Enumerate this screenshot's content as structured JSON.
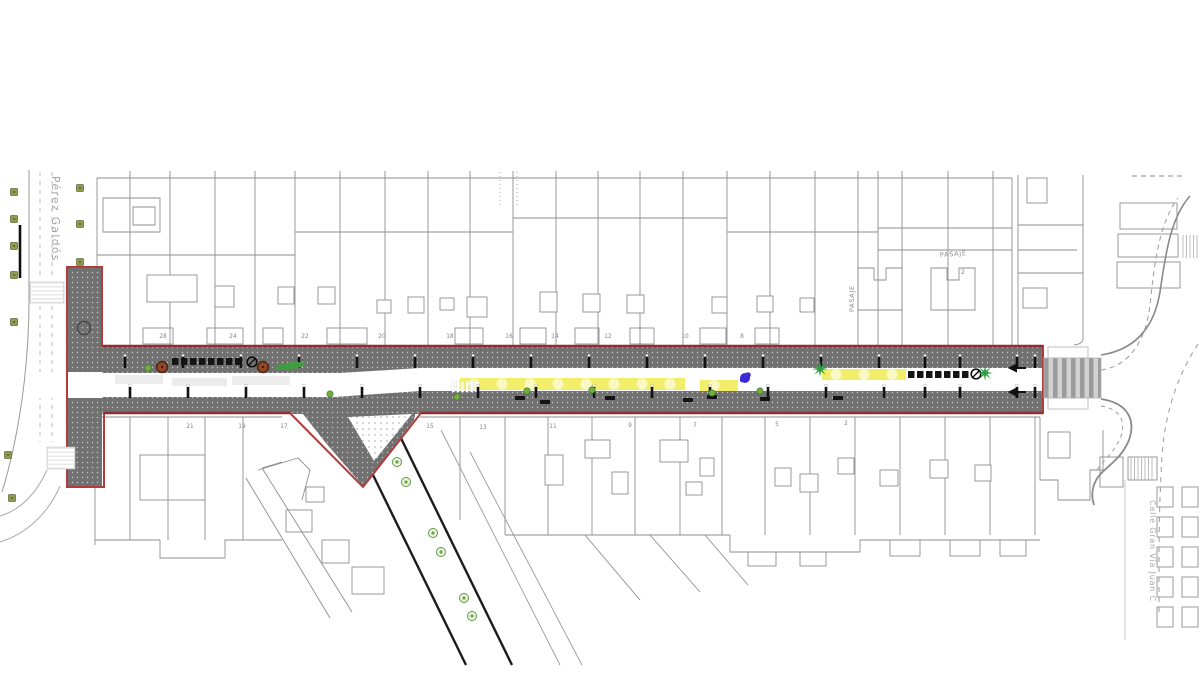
{
  "page": {
    "background": "#ffffff",
    "type": "urban-street-redevelopment-plan"
  },
  "labels": {
    "street_left": "Pérez Galdós",
    "street_right": "Calle Gran Vía Juan C",
    "passage_vertical": "PASAJE",
    "passage_horizontal": "PASAJE"
  },
  "building_numbers": {
    "north": [
      {
        "n": "28",
        "x": 163,
        "y": 338
      },
      {
        "n": "24",
        "x": 233,
        "y": 338
      },
      {
        "n": "22",
        "x": 305,
        "y": 338
      },
      {
        "n": "20",
        "x": 382,
        "y": 338
      },
      {
        "n": "18",
        "x": 450,
        "y": 338
      },
      {
        "n": "16",
        "x": 509,
        "y": 338
      },
      {
        "n": "14",
        "x": 555,
        "y": 338
      },
      {
        "n": "12",
        "x": 608,
        "y": 338
      },
      {
        "n": "10",
        "x": 685,
        "y": 338
      },
      {
        "n": "8",
        "x": 742,
        "y": 338
      },
      {
        "n": "2",
        "x": 963,
        "y": 274
      }
    ],
    "south": [
      {
        "n": "21",
        "x": 190,
        "y": 428
      },
      {
        "n": "19",
        "x": 242,
        "y": 428
      },
      {
        "n": "17",
        "x": 284,
        "y": 428
      },
      {
        "n": "15",
        "x": 430,
        "y": 428
      },
      {
        "n": "13",
        "x": 483,
        "y": 429
      },
      {
        "n": "11",
        "x": 553,
        "y": 428
      },
      {
        "n": "9",
        "x": 630,
        "y": 427
      },
      {
        "n": "7",
        "x": 695,
        "y": 427
      },
      {
        "n": "5",
        "x": 777,
        "y": 426
      },
      {
        "n": "2",
        "x": 846,
        "y": 425
      }
    ]
  },
  "colors": {
    "project_outline": "#b23c3c",
    "project_outline_dark": "#8d2f33",
    "sidewalk": "#717171",
    "sidewalk_dot": "#c9c9c9",
    "roadway": "#ffffff",
    "yellow_zone": "#f2ee6a",
    "yellow_highlight": "#fbfad0",
    "building_line": "#8e8e8e",
    "tree_olive": "#8f9c4e",
    "tree_brown": "#8f4526",
    "palm_green": "#2e9e43",
    "bush_green": "#6fae3f",
    "hedge_green": "#3f9d3f",
    "furniture_black": "#141414",
    "art_blue": "#3b2bd6",
    "crosswalk_gray": "#9b9b9b"
  },
  "features": {
    "bollards": {
      "top": {
        "y": 357,
        "x": [
          125,
          183,
          241,
          299,
          357,
          415,
          473,
          531,
          589,
          647,
          705,
          763,
          821,
          879,
          925,
          960,
          1017,
          1035
        ]
      },
      "bottom": {
        "y": 387,
        "x": [
          130,
          188,
          246,
          304,
          362,
          420,
          478,
          536,
          594,
          652,
          710,
          768,
          826,
          884,
          925,
          960,
          1017,
          1035
        ]
      }
    },
    "street_trees_brown": [
      [
        162,
        367
      ],
      [
        263,
        367
      ]
    ],
    "palm_trees": [
      [
        820,
        369
      ],
      [
        985,
        373
      ]
    ],
    "plaza_bushes": [
      [
        148,
        368
      ],
      [
        330,
        394
      ],
      [
        457,
        397
      ],
      [
        527,
        391
      ],
      [
        592,
        390
      ],
      [
        712,
        393
      ],
      [
        760,
        391
      ]
    ],
    "hedges": [
      [
        290,
        366
      ]
    ],
    "diagonal_trees": [
      [
        397,
        462
      ],
      [
        406,
        482
      ],
      [
        433,
        533
      ],
      [
        441,
        552
      ],
      [
        464,
        598
      ],
      [
        472,
        616
      ]
    ],
    "left_street_trees": [
      [
        14,
        192
      ],
      [
        14,
        219
      ],
      [
        14,
        246
      ],
      [
        14,
        275
      ],
      [
        14,
        322
      ],
      [
        80,
        188
      ],
      [
        80,
        224
      ],
      [
        80,
        262
      ],
      [
        8,
        455
      ],
      [
        12,
        498
      ]
    ],
    "benches": [
      [
        520,
        398
      ],
      [
        545,
        402
      ],
      [
        610,
        398
      ],
      [
        688,
        400
      ],
      [
        712,
        397
      ],
      [
        765,
        399
      ],
      [
        838,
        398
      ]
    ],
    "vehicle_rows": [
      {
        "x": 172,
        "y": 358,
        "count": 8
      },
      {
        "x": 908,
        "y": 371,
        "count": 7
      }
    ],
    "no_entry_markers": [
      [
        252,
        362
      ],
      [
        976,
        374
      ]
    ],
    "art_object": [
      745,
      378
    ],
    "yellow_zones": [
      [
        460,
        378,
        225,
        12
      ],
      [
        700,
        380,
        38,
        11
      ],
      [
        822,
        369,
        84,
        11
      ]
    ]
  }
}
